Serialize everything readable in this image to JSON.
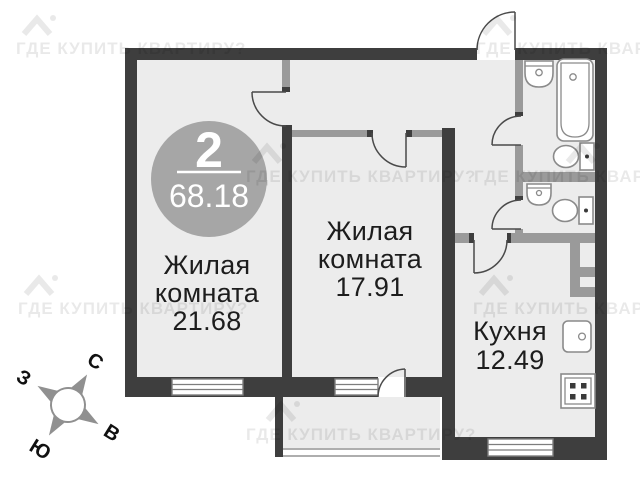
{
  "badge": {
    "rooms_count": "2",
    "total_area": "68.18"
  },
  "rooms": {
    "living1": {
      "line1": "Жилая",
      "line2": "комната",
      "area": "21.68"
    },
    "living2": {
      "line1": "Жилая",
      "line2": "комната",
      "area": "17.91"
    },
    "kitchen": {
      "line1": "Кухня",
      "area": "12.49"
    }
  },
  "compass": {
    "north": "С",
    "east": "В",
    "south": "Ю",
    "west": "З"
  },
  "watermark": {
    "text": "ГДЕ КУПИТЬ КВАРТИРУ?"
  },
  "colors": {
    "outer_wall": "#3e3e3e",
    "partition_wall": "#9a9a9a",
    "floor_fill": "#ececec",
    "badge_circle": "#a6a6a6",
    "fixture_outline": "#8a8a8a"
  }
}
